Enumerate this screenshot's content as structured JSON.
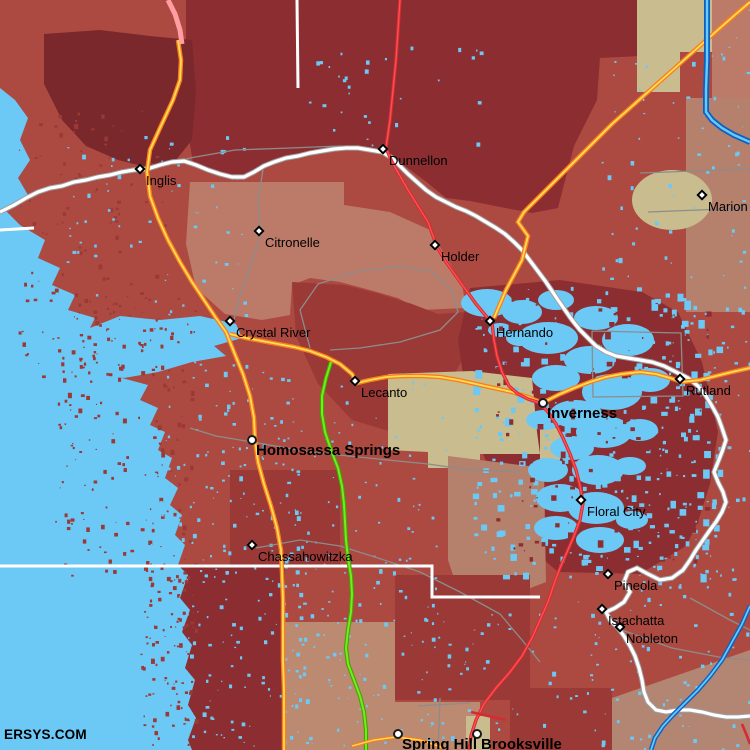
{
  "watermark": "ERSYS.COM",
  "map": {
    "towns": [
      {
        "name": "Inglis",
        "x": 142,
        "y": 171,
        "marker": "diamond",
        "large": false
      },
      {
        "name": "Dunnellon",
        "x": 385,
        "y": 151,
        "marker": "diamond",
        "large": false
      },
      {
        "name": "Marion",
        "x": 704,
        "y": 197,
        "marker": "diamond",
        "large": false
      },
      {
        "name": "Citronelle",
        "x": 261,
        "y": 233,
        "marker": "diamond",
        "large": false
      },
      {
        "name": "Holder",
        "x": 437,
        "y": 247,
        "marker": "diamond",
        "large": false
      },
      {
        "name": "Crystal River",
        "x": 232,
        "y": 323,
        "marker": "diamond",
        "large": false
      },
      {
        "name": "Hernando",
        "x": 492,
        "y": 323,
        "marker": "diamond",
        "large": false
      },
      {
        "name": "Lecanto",
        "x": 357,
        "y": 383,
        "marker": "diamond",
        "large": false
      },
      {
        "name": "Inverness",
        "x": 543,
        "y": 403,
        "marker": "circle",
        "large": true
      },
      {
        "name": "Rutland",
        "x": 682,
        "y": 381,
        "marker": "diamond",
        "large": false
      },
      {
        "name": "Homosassa Springs",
        "x": 252,
        "y": 440,
        "marker": "circle",
        "large": true
      },
      {
        "name": "Floral City",
        "x": 583,
        "y": 502,
        "marker": "diamond",
        "large": false
      },
      {
        "name": "Chassahowitzka",
        "x": 254,
        "y": 547,
        "marker": "diamond",
        "large": false
      },
      {
        "name": "Pineola",
        "x": 610,
        "y": 576,
        "marker": "diamond",
        "large": false
      },
      {
        "name": "Istachatta",
        "x": 604,
        "y": 611,
        "marker": "diamond",
        "large": false
      },
      {
        "name": "Nobleton",
        "x": 622,
        "y": 629,
        "marker": "diamond",
        "large": false
      },
      {
        "name": "Spring Hill",
        "x": 398,
        "y": 734,
        "marker": "circle",
        "large": true
      },
      {
        "name": "Brooksville",
        "x": 477,
        "y": 734,
        "marker": "circle",
        "large": true
      }
    ],
    "colors": {
      "water": "#6CC9F5",
      "med": "#AC4A42",
      "dark": "#8C2E31",
      "darker": "#7B282C",
      "dark2": "#9A3936",
      "salmon": "#BC7B69",
      "salmon2": "#B5806C",
      "lbrown": "#BB8A70",
      "brcorner": "#B28672",
      "tan": "#C9BD8F",
      "orange": "#F97F1E",
      "yellow": "#FFDE54",
      "red": "#D52B32",
      "redcore": "#FF5050",
      "green": "#76EC1C",
      "greendark": "#44A403",
      "blue": "#0E5FC4",
      "bluecore": "#66CCF5",
      "white": "#FFFFFF",
      "gray": "#8C8C8C",
      "graycase": "#A0A0A0",
      "pink": "#FF9DA0",
      "label": "#000000"
    }
  }
}
